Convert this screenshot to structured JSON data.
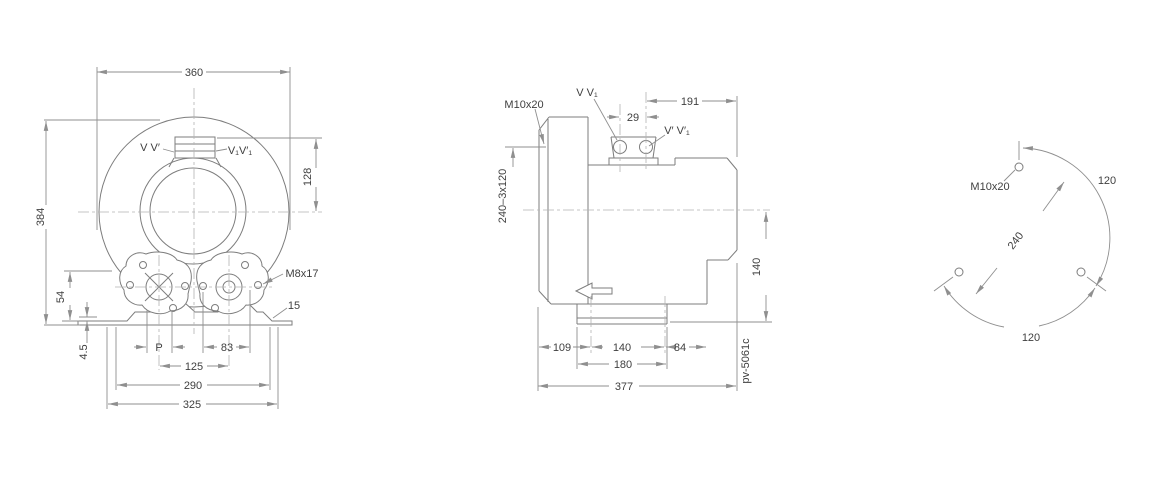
{
  "drawing_code": "pv-5061c",
  "front_view": {
    "dim_overall_width": "360",
    "dim_overall_height": "384",
    "dim_port_height": "128",
    "label_port_left": "V V′",
    "label_port_right": "V₁V′₁",
    "label_thread": "M8x17",
    "dim_slot_width": "15",
    "dim_foot_height": "54",
    "dim_plate_thickness": "4.5",
    "label_port_size": "P",
    "dim_hole_offset": "83",
    "dim_port_spacing": "125",
    "dim_base_holes": "290",
    "dim_base_width": "325"
  },
  "side_view": {
    "label_thread": "M10x20",
    "label_ports_top": "V V₁",
    "dim_port_spacing": "29",
    "dim_port_to_face": "191",
    "label_ports_side": "V′ V′₁",
    "dim_bolt_circle": "240–3x120",
    "dim_height_center": "140",
    "dim_face_to_hole": "109",
    "dim_foot_holes": "140",
    "dim_hole_to_face": "84",
    "dim_foot_length": "180",
    "dim_overall_length": "377"
  },
  "bolt_circle_view": {
    "label_thread": "M10x20",
    "dim_pitch_diameter": "240",
    "dim_angle_upper": "120",
    "dim_angle_lower": "120"
  }
}
